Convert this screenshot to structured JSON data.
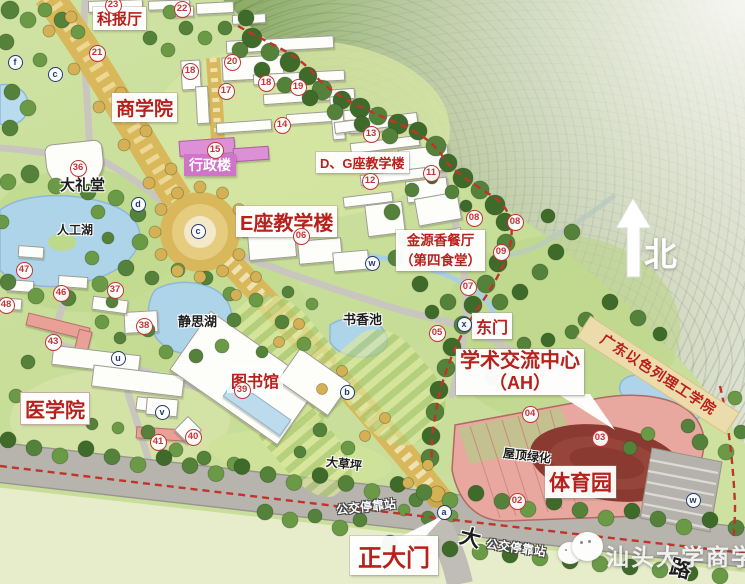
{
  "map_labels": {
    "science_hall": "科报厅",
    "business_school": "商学院",
    "admin_building": "行政楼",
    "auditorium": "大礼堂",
    "artificial_lake": "人工湖",
    "building_e": "E座教学楼",
    "building_dg": "D、G座教学楼",
    "canteen_name": "金源香餐厅",
    "canteen_sub": "（第四食堂）",
    "east_gate": "东门",
    "jingsi_lake": "静思湖",
    "shuxiang_pond": "书香池",
    "library": "图书馆",
    "medical_school": "医学院",
    "academic_center": "学术交流中心",
    "academic_center_sub": "（AH）",
    "gtiit": "广东以色列理工学院",
    "sports_park": "体育园",
    "roof_greening": "屋顶绿化",
    "great_lawn": "大草坪",
    "bus_stop_west": "公交停靠站",
    "bus_stop_east": "公交停靠站",
    "main_gate": "正大门",
    "north": "北",
    "road_char_da": "大",
    "road_char_lu": "路",
    "watermark": "汕头大学商学院"
  },
  "markers": {
    "numbers": [
      {
        "n": "23",
        "x": 113,
        "y": 5
      },
      {
        "n": "22",
        "x": 182,
        "y": 9
      },
      {
        "n": "21",
        "x": 97,
        "y": 53
      },
      {
        "n": "20",
        "x": 232,
        "y": 62
      },
      {
        "n": "18",
        "x": 190,
        "y": 71
      },
      {
        "n": "18",
        "x": 266,
        "y": 83
      },
      {
        "n": "17",
        "x": 226,
        "y": 91
      },
      {
        "n": "19",
        "x": 298,
        "y": 87
      },
      {
        "n": "14",
        "x": 282,
        "y": 125
      },
      {
        "n": "15",
        "x": 215,
        "y": 150
      },
      {
        "n": "36",
        "x": 78,
        "y": 168
      },
      {
        "n": "13",
        "x": 371,
        "y": 134
      },
      {
        "n": "11",
        "x": 431,
        "y": 173
      },
      {
        "n": "12",
        "x": 370,
        "y": 181
      },
      {
        "n": "06",
        "x": 301,
        "y": 236
      },
      {
        "n": "08",
        "x": 474,
        "y": 218
      },
      {
        "n": "08",
        "x": 515,
        "y": 222
      },
      {
        "n": "09",
        "x": 501,
        "y": 252
      },
      {
        "n": "07",
        "x": 468,
        "y": 287
      },
      {
        "n": "05",
        "x": 437,
        "y": 333
      },
      {
        "n": "47",
        "x": 24,
        "y": 270
      },
      {
        "n": "46",
        "x": 61,
        "y": 293
      },
      {
        "n": "37",
        "x": 115,
        "y": 290
      },
      {
        "n": "48",
        "x": 6,
        "y": 305
      },
      {
        "n": "38",
        "x": 144,
        "y": 326
      },
      {
        "n": "43",
        "x": 53,
        "y": 342
      },
      {
        "n": "39",
        "x": 242,
        "y": 390
      },
      {
        "n": "40",
        "x": 193,
        "y": 437
      },
      {
        "n": "41",
        "x": 158,
        "y": 442
      },
      {
        "n": "04",
        "x": 530,
        "y": 414
      },
      {
        "n": "03",
        "x": 600,
        "y": 438
      },
      {
        "n": "02",
        "x": 517,
        "y": 501
      }
    ],
    "letters": [
      {
        "l": "f",
        "x": 15,
        "y": 62
      },
      {
        "l": "c",
        "x": 55,
        "y": 74
      },
      {
        "l": "d",
        "x": 138,
        "y": 204
      },
      {
        "l": "c",
        "x": 198,
        "y": 231
      },
      {
        "l": "w",
        "x": 372,
        "y": 263
      },
      {
        "l": "u",
        "x": 118,
        "y": 358
      },
      {
        "l": "b",
        "x": 347,
        "y": 392
      },
      {
        "l": "v",
        "x": 162,
        "y": 412
      },
      {
        "l": "x",
        "x": 464,
        "y": 324
      },
      {
        "l": "a",
        "x": 444,
        "y": 512
      },
      {
        "l": "w",
        "x": 693,
        "y": 500
      }
    ]
  },
  "colors": {
    "label_red": "#b8201c",
    "boundary_red": "#c23329",
    "admin_pink": "#cf74c9",
    "stadium_pink": "#e8a8a0",
    "water_blue": "#aed4ea",
    "boulevard_gold": "#d9b85c"
  }
}
